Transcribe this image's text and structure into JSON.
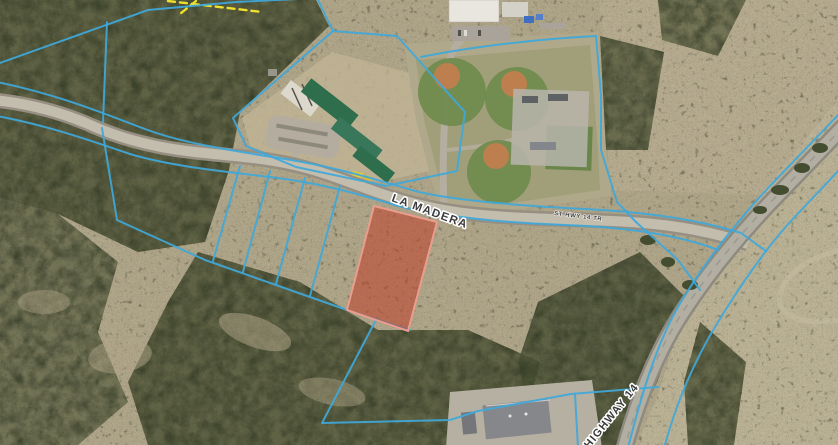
{
  "map": {
    "road_labels": {
      "la_madera": "LA MADERA",
      "highway_14": "HIGHWAY 14",
      "frontage_small": "ST HWY 14 TR"
    },
    "colors": {
      "parcel_line": "#3fa8da",
      "selected_parcel_fill": "#c03a22",
      "selected_parcel_stroke": "#eb9d8d",
      "survey_line": "#f0e02c",
      "road_label_text": "#3b3b3b",
      "road_label_halo": "#ffffff"
    }
  }
}
